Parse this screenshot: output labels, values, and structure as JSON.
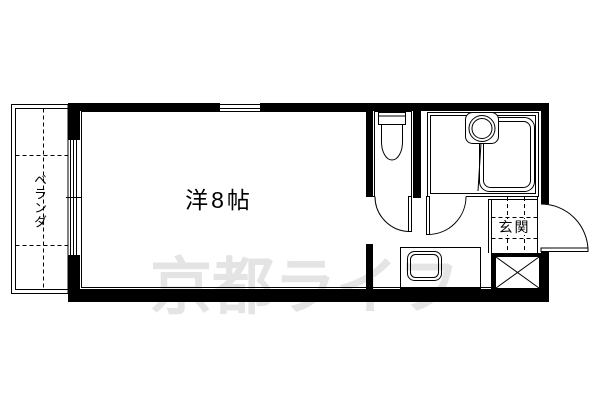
{
  "floorplan": {
    "labels": {
      "main_room": "洋8帖",
      "balcony": "ベランダ",
      "entrance": "玄関"
    },
    "icons": [
      {
        "name": "toilet-icon"
      },
      {
        "name": "washbasin-icon"
      },
      {
        "name": "bathtub-icon"
      },
      {
        "name": "kitchen-sink-icon"
      },
      {
        "name": "door-swing-arc"
      },
      {
        "name": "pipe-space-x-icon"
      },
      {
        "name": "sliding-window"
      },
      {
        "name": "tile-grid"
      }
    ],
    "colors": {
      "line": "#000000",
      "floor": "#ffffff"
    }
  },
  "watermark": {
    "text": "京都ライフ",
    "color": "#e4e4e4"
  }
}
